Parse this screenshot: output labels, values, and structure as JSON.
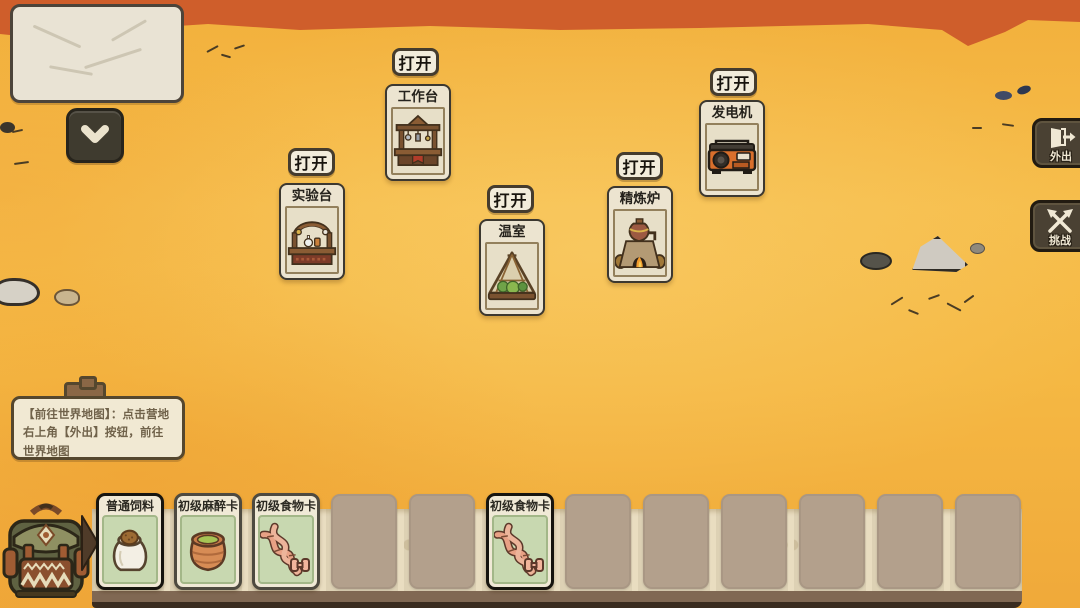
{
  "colors": {
    "sand": "#f5b843",
    "terrain_band": "#cf5e2b",
    "card_cream": "#ece4d0",
    "card_green": "#c8d8b0",
    "tray": "#ddd1b4",
    "tray_strip": "#806853",
    "dark_button": "#4a4133",
    "open_button_bg": "#f2ecdb"
  },
  "collapse_button": {
    "icon": "chevron-down-icon"
  },
  "building_cards": [
    {
      "id": "workbench",
      "title": "工作台",
      "action": "打开",
      "icon": "workbench-icon"
    },
    {
      "id": "lab-bench",
      "title": "实验台",
      "action": "打开",
      "icon": "lab-bench-icon"
    },
    {
      "id": "greenhouse",
      "title": "温室",
      "action": "打开",
      "icon": "greenhouse-icon"
    },
    {
      "id": "refinery-furnace",
      "title": "精炼炉",
      "action": "打开",
      "icon": "refinery-furnace-icon"
    },
    {
      "id": "generator",
      "title": "发电机",
      "action": "打开",
      "icon": "generator-icon"
    }
  ],
  "side_buttons": [
    {
      "id": "go-out",
      "label": "外出",
      "icon": "exit-door-icon"
    },
    {
      "id": "challenge",
      "label": "挑战",
      "icon": "crossed-axes-icon"
    }
  ],
  "tutorial_tooltip": {
    "icon": "toolbox-icon",
    "text": "【前往世界地图】：点击营地右上角【外出】按钮，前往世界地图"
  },
  "hand_tray": {
    "backpack_icon": "backpack-icon",
    "expand_arrow_icon": "arrow-right-icon",
    "slots": [
      {
        "type": "card",
        "title": "普通饲料",
        "icon": "feed-bag-icon",
        "highlighted": true
      },
      {
        "type": "card",
        "title": "初级麻醉卡",
        "icon": "clay-pot-icon",
        "highlighted": false
      },
      {
        "type": "card",
        "title": "初级食物卡",
        "icon": "dna-icon",
        "highlighted": false
      },
      {
        "type": "empty"
      },
      {
        "type": "empty"
      },
      {
        "type": "card",
        "title": "初级食物卡",
        "icon": "dna-icon",
        "highlighted": true
      },
      {
        "type": "empty"
      },
      {
        "type": "empty"
      },
      {
        "type": "empty"
      },
      {
        "type": "empty"
      },
      {
        "type": "empty"
      },
      {
        "type": "empty"
      }
    ]
  }
}
